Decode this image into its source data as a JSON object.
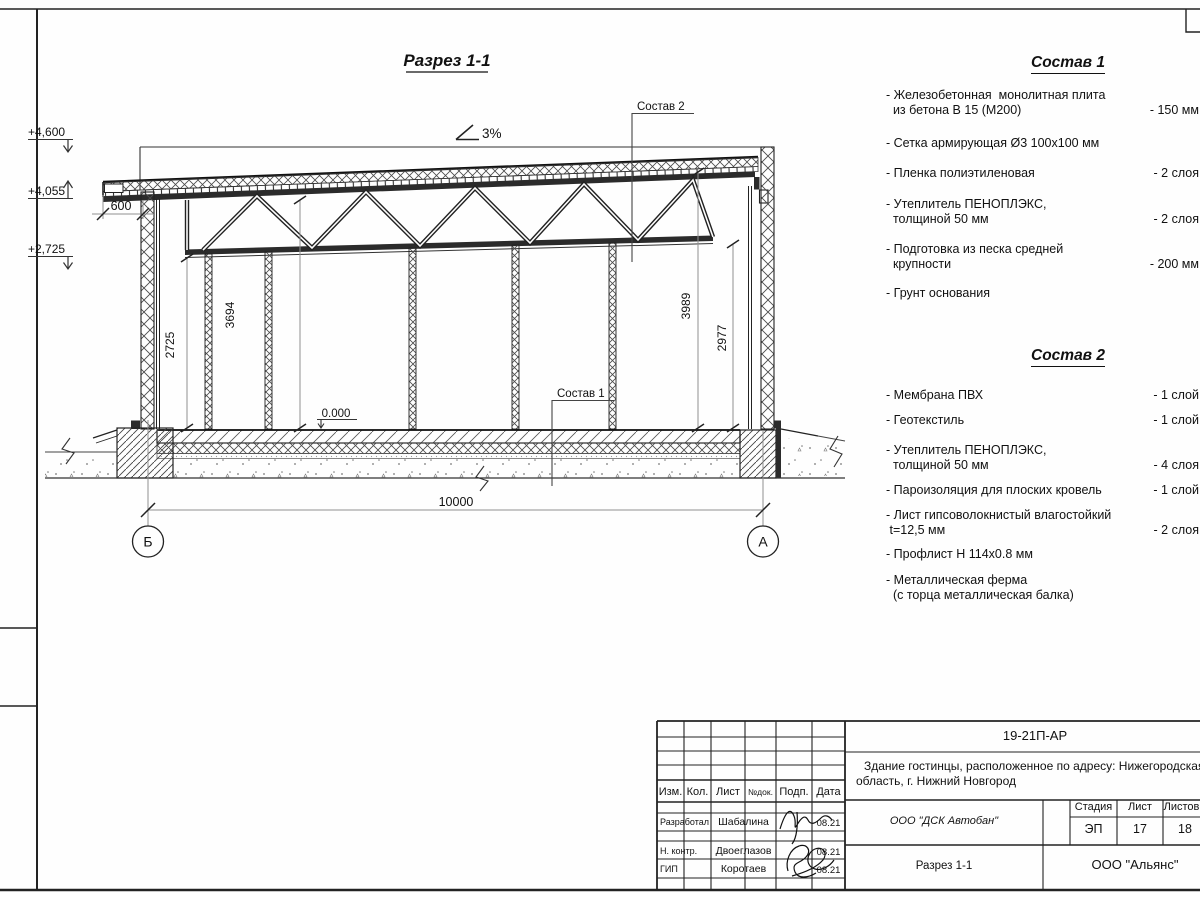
{
  "drawing": {
    "title": "Разрез 1-1",
    "slope_label": "3%",
    "callout_sostav1": "Состав 1",
    "callout_sostav2": "Состав 2",
    "level_zero": "0.000",
    "elevations": {
      "parapet": "+4,600",
      "overhang": "+4,055",
      "truss_bottom": "+2,725"
    },
    "dims": {
      "overhang": "600",
      "left_clear_height": "2725",
      "left_top_height": "3694",
      "right_top_height": "3989",
      "right_clear_height": "2977",
      "span": "10000"
    },
    "axes": {
      "left": "Б",
      "right": "А"
    }
  },
  "sostav1": {
    "title": "Состав 1",
    "items": [
      {
        "label": "- Железобетонная  монолитная плита\n  из бетона В 15 (М200)",
        "value": "- 150 мм"
      },
      {
        "label": "- Сетка армирующая Ø3 100х100 мм",
        "value": ""
      },
      {
        "label": "- Пленка полиэтиленовая",
        "value": "-  2 слоя"
      },
      {
        "label": "- Утеплитель ПЕНОПЛЭКС,\n  толщиной 50 мм",
        "value": "- 2 слоя"
      },
      {
        "label": "- Подготовка из песка средней\n  крупности",
        "value": "- 200 мм"
      },
      {
        "label": "- Грунт основания",
        "value": ""
      }
    ]
  },
  "sostav2": {
    "title": "Состав 2",
    "items": [
      {
        "label": "- Мембрана ПВХ",
        "value": "- 1 слой"
      },
      {
        "label": "- Геотекстиль",
        "value": "- 1 слой"
      },
      {
        "label": "- Утеплитель ПЕНОПЛЭКС,\n  толщиной 50 мм",
        "value": "- 4 слоя"
      },
      {
        "label": "- Пароизоляция для плоских кровель",
        "value": "- 1 слой"
      },
      {
        "label": "- Лист гипсоволокнистый влагостойкий\n t=12,5 мм",
        "value": "- 2 слоя"
      },
      {
        "label": "- Профлист Н 114х0.8 мм",
        "value": ""
      },
      {
        "label": "- Металлическая ферма\n  (с торца металлическая балка)",
        "value": ""
      }
    ]
  },
  "titleblock": {
    "doc_number": "19-21П-АР",
    "project_line1": "Здание гостинцы, расположенное по адресу: Нижегородская",
    "project_line2": "область, г. Нижний Новгород",
    "columns": {
      "izm": "Изм.",
      "kol": "Кол.",
      "list": "Лист",
      "ndok": "№док.",
      "podp": "Подп.",
      "data": "Дата"
    },
    "rows": {
      "razrabotal": {
        "role": "Разработал",
        "name": "Шабалина",
        "date": "08.21"
      },
      "nkontr": {
        "role": "Н. контр.",
        "name": "Двоеглазов",
        "date": "08.21"
      },
      "gip": {
        "role": "ГИП",
        "name": "Коротаев",
        "date": "08.21"
      }
    },
    "org": "ООО \"ДСК Автобан\"",
    "stage_label": "Стадия",
    "sheet_label": "Лист",
    "sheets_label": "Листов",
    "stage": "ЭП",
    "sheet": "17",
    "sheets": "18",
    "section_title": "Разрез 1-1",
    "company": "ООО \"Альянс\""
  },
  "colors": {
    "line": "#222222",
    "dim": "#909090",
    "dark_fill": "#2b2b2b"
  }
}
